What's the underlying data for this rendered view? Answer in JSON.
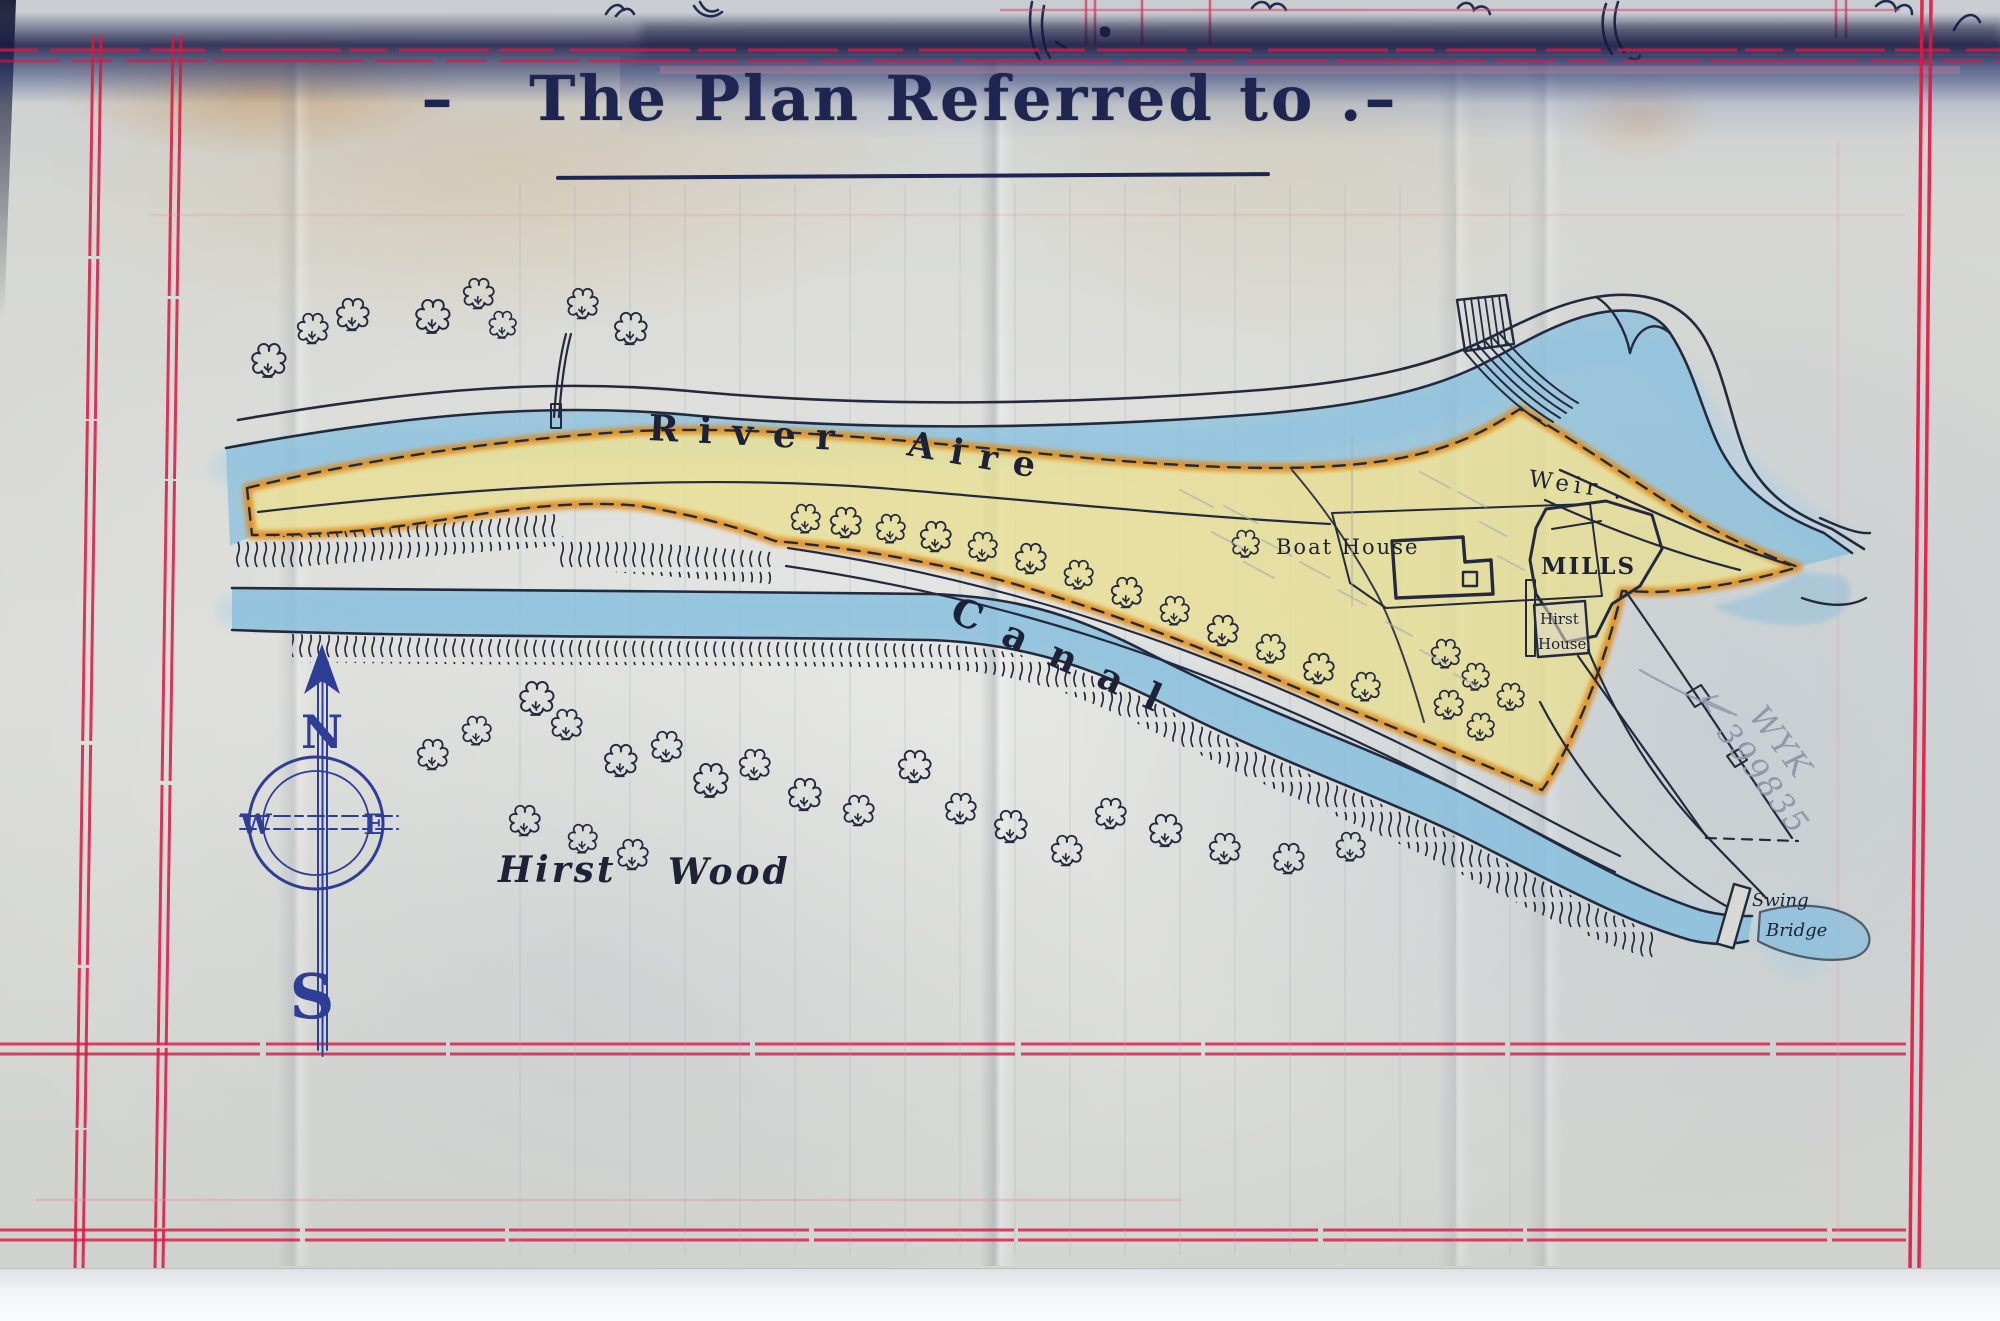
{
  "document": {
    "title": "–   The Plan Referred to .–"
  },
  "map": {
    "river_label": {
      "word1": "River",
      "word2": "Aire"
    },
    "canal_label": "Canal",
    "wood_label": {
      "word1": "Hirst",
      "word2": "Wood"
    },
    "weir_label": "Weir .",
    "mills_label": "MILLS",
    "boat_house_label": "Boat House",
    "hirst_house_label": {
      "line1": "Hirst",
      "line2": "House"
    },
    "swing_bridge_label": {
      "line1": "Swing",
      "line2": "Bridge"
    },
    "compass": {
      "north": "N",
      "south": "S",
      "east": "E",
      "west": "W"
    }
  },
  "annotations": {
    "pencil_note": {
      "line1": "WYK",
      "line2": "399835"
    }
  },
  "colors": {
    "map_ink": "#232a3e",
    "compass_blue_ink": "#2e3d96",
    "title_ink": "#1d2550",
    "water_blue": "#85bedd",
    "land_yellow": "#eadf8e",
    "border_orange": "#e08a18",
    "ledger_red": "#dc1743",
    "pencil_gray": "#9298ab",
    "paper": "#d7d8d4"
  }
}
